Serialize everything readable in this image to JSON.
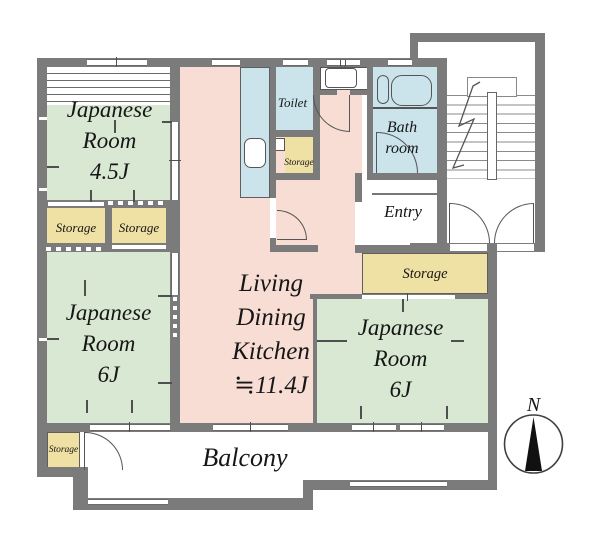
{
  "colors": {
    "wall": "#7b7b7b",
    "tatami": "#d8e8d2",
    "ldk": "#f8ddd5",
    "water": "#cbe4ec",
    "storage": "#efe0a3",
    "line": "#555555",
    "ink": "#161616",
    "paper": "#ffffff"
  },
  "rooms": {
    "jp45": {
      "lines": [
        "Japanese",
        "Room",
        "4.5J"
      ]
    },
    "jp6_left": {
      "lines": [
        "Japanese",
        "Room",
        "6J"
      ]
    },
    "jp6_right": {
      "lines": [
        "Japanese",
        "Room",
        "6J"
      ]
    },
    "ldk": {
      "lines": [
        "Living",
        "Dining",
        "Kitchen",
        "≒11.4J"
      ]
    },
    "toilet": {
      "label": "Toilet"
    },
    "bathroom": {
      "lines": [
        "Bath",
        "room"
      ]
    },
    "entry": {
      "label": "Entry"
    },
    "balcony": {
      "label": "Balcony"
    },
    "storage_mid_left": {
      "label": "Storage"
    },
    "storage_mid_right": {
      "label": "Storage"
    },
    "storage_toilet": {
      "label": "Storage"
    },
    "storage_right": {
      "label": "Storage"
    },
    "storage_balcony": {
      "label": "Storage"
    }
  },
  "compass": {
    "north_label": "N"
  }
}
